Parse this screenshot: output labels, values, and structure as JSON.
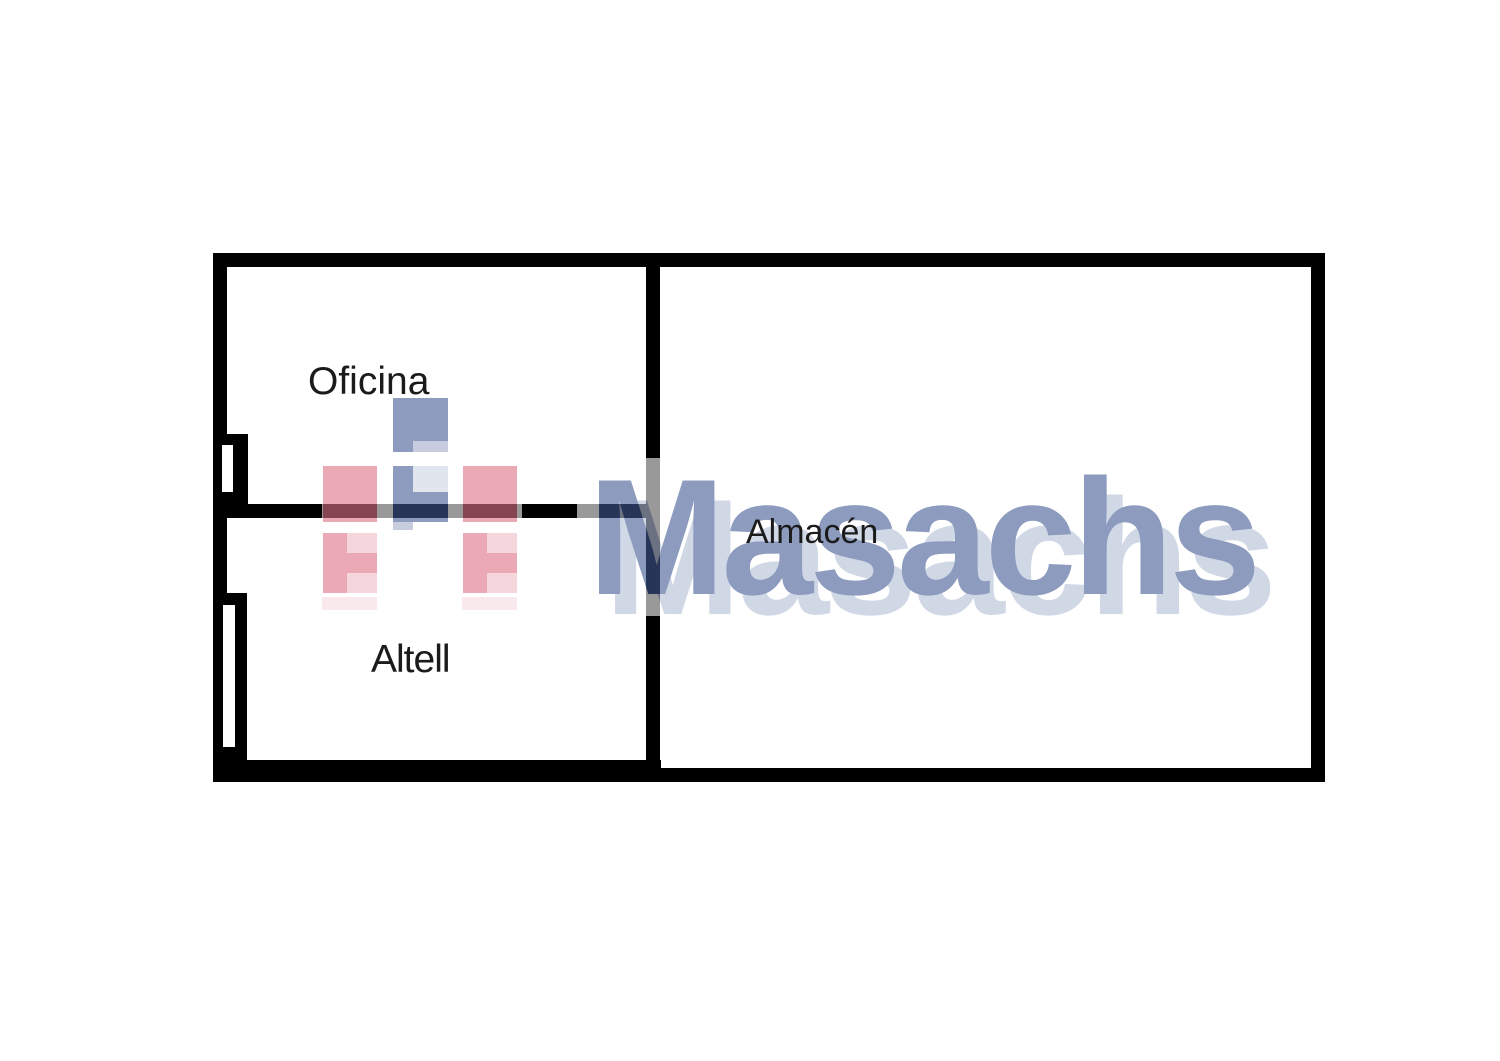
{
  "document": {
    "type_label": "floor plan",
    "background_color": "#ffffff",
    "wall_color": "#000000"
  },
  "rooms": [
    {
      "name": "Oficina"
    },
    {
      "name": "Altell"
    },
    {
      "name": "Almacén"
    }
  ],
  "watermark": {
    "brand": "Masachs",
    "opacity": 0.6,
    "colors": {
      "brand_blue": "#415a93",
      "ghost_blue": "#b2bdd5",
      "light_blue": "#a3adcb",
      "pale_blue": "#cdd5e3",
      "pink": "#df7185",
      "light_pink": "#f0bbc5",
      "faint_pink": "#f6dce2"
    }
  }
}
